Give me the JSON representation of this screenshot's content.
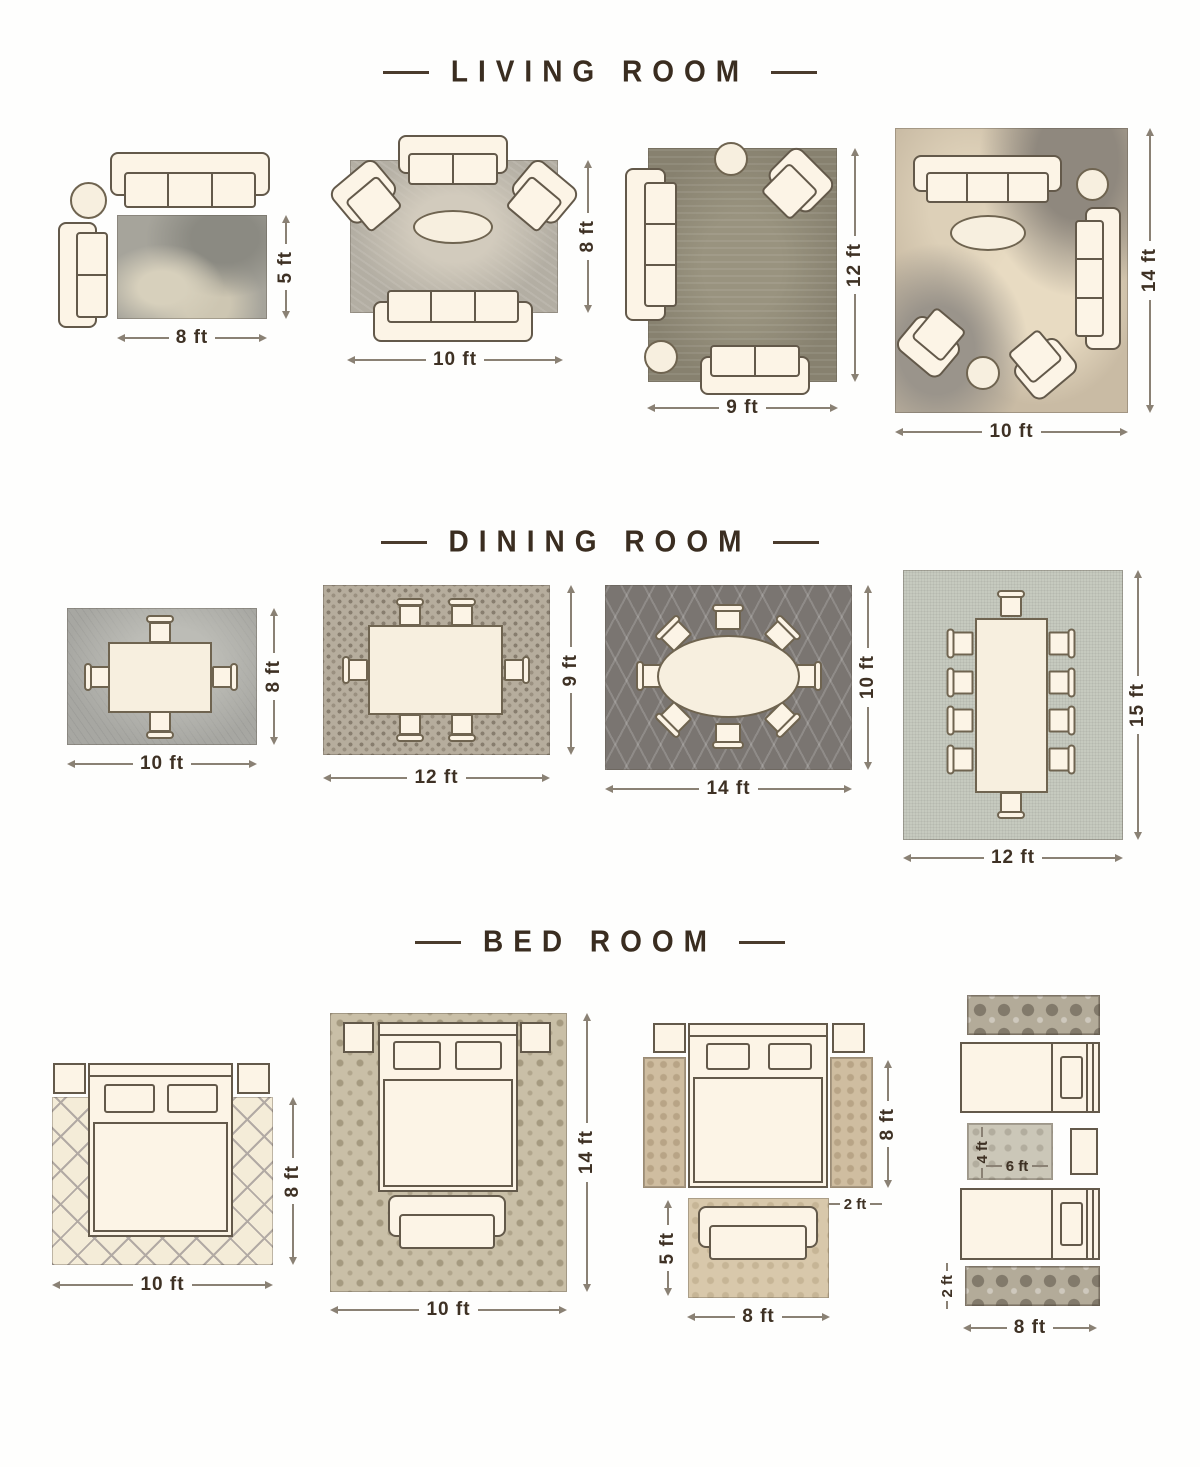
{
  "titles": {
    "living": "LIVING ROOM",
    "dining": "DINING ROOM",
    "bedroom": "BED ROOM"
  },
  "living": [
    {
      "width": "8 ft",
      "height": "5 ft"
    },
    {
      "width": "10 ft",
      "height": "8 ft"
    },
    {
      "width": "9 ft",
      "height": "12 ft"
    },
    {
      "width": "10 ft",
      "height": "14 ft"
    }
  ],
  "dining": [
    {
      "width": "10 ft",
      "height": "8 ft"
    },
    {
      "width": "12 ft",
      "height": "9 ft"
    },
    {
      "width": "14 ft",
      "height": "10 ft"
    },
    {
      "width": "12 ft",
      "height": "15 ft"
    }
  ],
  "bedroom": [
    {
      "width": "10 ft",
      "height": "8 ft"
    },
    {
      "width": "10 ft",
      "height": "14 ft"
    },
    {
      "bed_rug_length": "8 ft",
      "runner_width": "2 ft",
      "foot_rug_height": "5 ft",
      "foot_rug_width": "8 ft"
    },
    {
      "between_rug_height": "4 ft",
      "between_rug_width": "6 ft",
      "runner_height": "2 ft",
      "runner_width": "8 ft"
    }
  ],
  "palette": {
    "title_color": "#3a2d20",
    "furniture_fill": "#fcf4e6",
    "furniture_outline": "#63594a",
    "dim_line_color": "#8a8174"
  }
}
